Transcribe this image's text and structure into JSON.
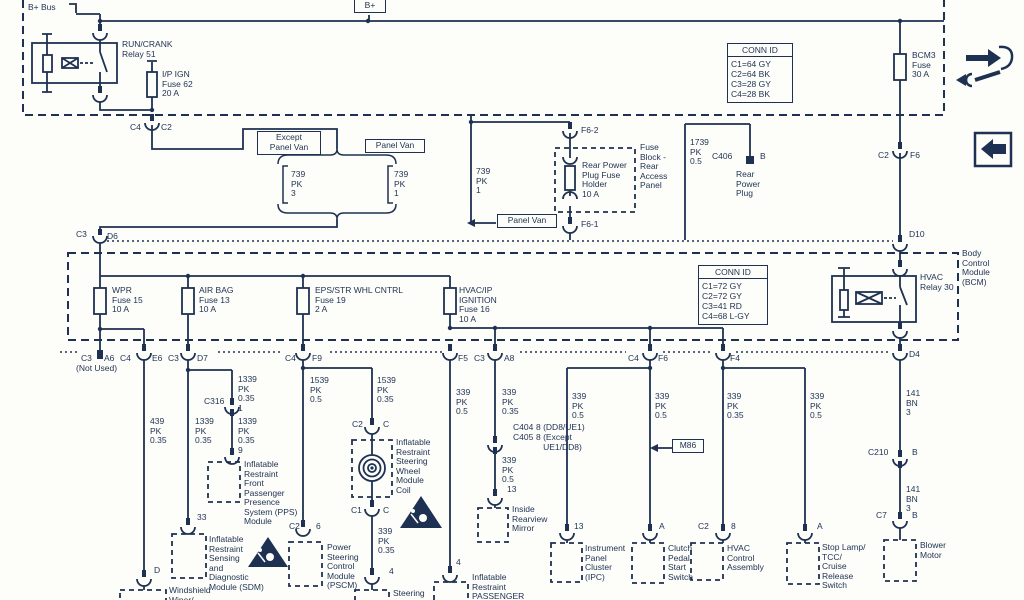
{
  "colors": {
    "ink": "#1e3152",
    "bg": "#fdfdfa"
  },
  "top": {
    "bplus_bus": "B+ Bus",
    "bplus_tag": "B+",
    "relay51": "RUN/CRANK\nRelay 51",
    "fuse62": "I/P IGN\nFuse 62\n20 A",
    "fuse_bcm3": "BCM3\nFuse\n30 A",
    "pin_c4": "C4",
    "pin_c2": "C2",
    "conn_id": {
      "title": "CONN ID",
      "rows": [
        "C1=64 GY",
        "C2=64 BK",
        "C3=28 GY",
        "C4=28 BK"
      ]
    }
  },
  "mid": {
    "except_panel_van": "Except\nPanel Van",
    "panel_van_a": "Panel Van",
    "panel_van_b": "Panel Van",
    "pk739_3": "739\nPK\n3",
    "pk739_1a": "739\nPK\n1",
    "pk739_1b": "739\nPK\n1",
    "f6_2": "F6-2",
    "f6_1": "F6-1",
    "fuse_block": "Fuse\nBlock -\nRear\nAccess\nPanel",
    "rear_fuse": "Rear Power\nPlug Fuse\nHolder\n10 A",
    "pk1739": "1739\nPK\n0.5",
    "c406": "C406",
    "pin_b": "B",
    "rear_plug": "Rear\nPower\nPlug",
    "pin_c3": "C3",
    "pin_d6": "D6",
    "pin_c2": "C2",
    "pin_f6": "F6",
    "pin_d10": "D10"
  },
  "bcm": {
    "name": "Body\nControl\nModule\n(BCM)",
    "fuse15": "WPR\nFuse 15\n10 A",
    "fuse13": "AIR BAG\nFuse 13\n10 A",
    "fuse19": "EPS/STR WHL CNTRL\nFuse 19\n2 A",
    "fuse16": "HVAC/IP\nIGNITION\nFuse 16\n10 A",
    "relay30": "HVAC\nRelay 30",
    "conn_id": {
      "title": "CONN ID",
      "rows": [
        "C1=72 GY",
        "C2=72 GY",
        "C3=41 RD",
        "C4=68 L-GY"
      ]
    },
    "pins": {
      "c3": "C3",
      "a6": "A6",
      "c4a": "C4",
      "not_used": "(Not Used)",
      "e6": "E6",
      "c3b": "C3",
      "d7": "D7",
      "c4b": "C4",
      "f9": "F9",
      "f5": "F5",
      "c3c": "C3",
      "a8": "A8",
      "c4c": "C4",
      "f6": "F6",
      "f4": "F4",
      "d4": "D4"
    }
  },
  "wiper": {
    "wire": "439\nPK\n0.35",
    "pin_d": "D",
    "module": "Windshield\nWiper/"
  },
  "sdm": {
    "wire": "1339\nPK\n0.35",
    "pin33": "33",
    "module": "Inflatable\nRestraint\nSensing\nand\nDiagnostic\nModule (SDM)"
  },
  "pps": {
    "wire1": "1339\nPK\n0.35\n1",
    "c316": "C316",
    "wire2": "1339\nPK\n0.35\n9",
    "module": "Inflatable\nRestraint\nFront\nPassenger\nPresence\nSystem (PPS)\nModule"
  },
  "pscm": {
    "wire": "1539\nPK\n0.5",
    "pin_c2": "C2",
    "pin6": "6",
    "module": "Power\nSteering\nControl\nModule\n(PSCM)"
  },
  "coil": {
    "wire": "1539\nPK\n0.35",
    "pin_c2": "C2",
    "pin_ca": "C",
    "module": "Inflatable\nRestraint\nSteering\nWheel\nModule\nCoil",
    "pin_c1": "C1",
    "pin_cb": "C",
    "wire2": "339\nPK\n0.35",
    "pin4": "4",
    "module2": "Steering"
  },
  "passenger": {
    "wire": "339\nPK\n0.5",
    "pin4": "4",
    "module": "Inflatable\nRestraint\nPASSENGER"
  },
  "mirror": {
    "wire": "339\nPK\n0.35",
    "c404": "C404\nC405",
    "pin8a": "8 (DD8/UE1)",
    "pin8b": "8 (Except\n   UE1/DD8)",
    "wire2": "339\nPK\n0.5",
    "pin13": "13",
    "module": "Inside\nRearview\nMirror"
  },
  "ipc": {
    "wire": "339\nPK\n0.5",
    "pin13": "13",
    "module": "Instrument\nPanel\nCluster\n(IPC)"
  },
  "clutch": {
    "wire": "339\nPK\n0.5",
    "pin_a": "A",
    "m86": "M86",
    "module": "Clutch\nPedal\nStart\nSwitch"
  },
  "hvac": {
    "wire": "339\nPK\n0.35",
    "pin_c2": "C2",
    "pin8": "8",
    "module": "HVAC\nControl\nAssembly"
  },
  "stop": {
    "wire": "339\nPK\n0.5",
    "pin_a": "A",
    "module": "Stop Lamp/\nTCC/\nCruise\nRelease\nSwitch"
  },
  "blower": {
    "wire1": "141\nBN\n3",
    "c210": "C210",
    "b1": "B",
    "wire2": "141\nBN\n3",
    "c7": "C7",
    "b2": "B",
    "module": "Blower\nMotor"
  }
}
